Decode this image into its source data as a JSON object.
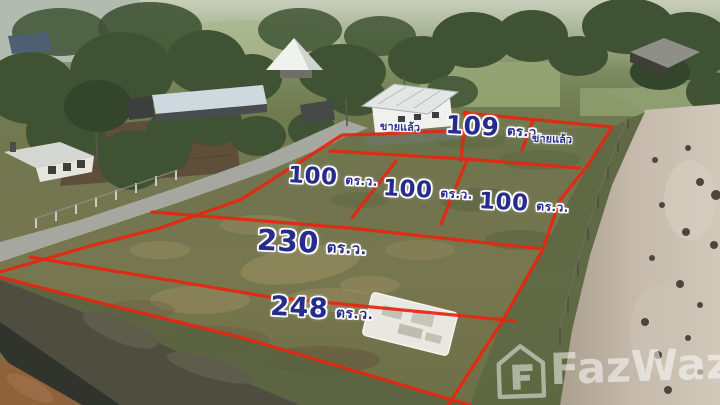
{
  "scene": {
    "description": "aerial drone photo of subdivided land plots for sale",
    "unit_meaning": "square wah"
  },
  "colors": {
    "plot_boundary_red": "#e8250f",
    "plot_label_navy": "#262c8d",
    "label_outline": "#ffffff",
    "watermark_white": "rgba(255,255,255,0.52)"
  },
  "plots": [
    {
      "name": "house-plot",
      "status_label": "ขายแล้ว"
    },
    {
      "name": "plot-109",
      "size": "109",
      "unit": "ตร.ว."
    },
    {
      "name": "plot-sold-right",
      "status_label": "ขายแล้ว"
    },
    {
      "name": "plot-100-left",
      "size": "100",
      "unit": "ตร.ว."
    },
    {
      "name": "plot-100-middle",
      "size": "100",
      "unit": "ตร.ว."
    },
    {
      "name": "plot-100-right",
      "size": "100",
      "unit": "ตร.ว."
    },
    {
      "name": "plot-230",
      "size": "230",
      "unit": "ตร.ว."
    },
    {
      "name": "plot-248",
      "size": "248",
      "unit": "ตร.ว."
    }
  ],
  "watermark": {
    "brand": "FazWaz"
  }
}
